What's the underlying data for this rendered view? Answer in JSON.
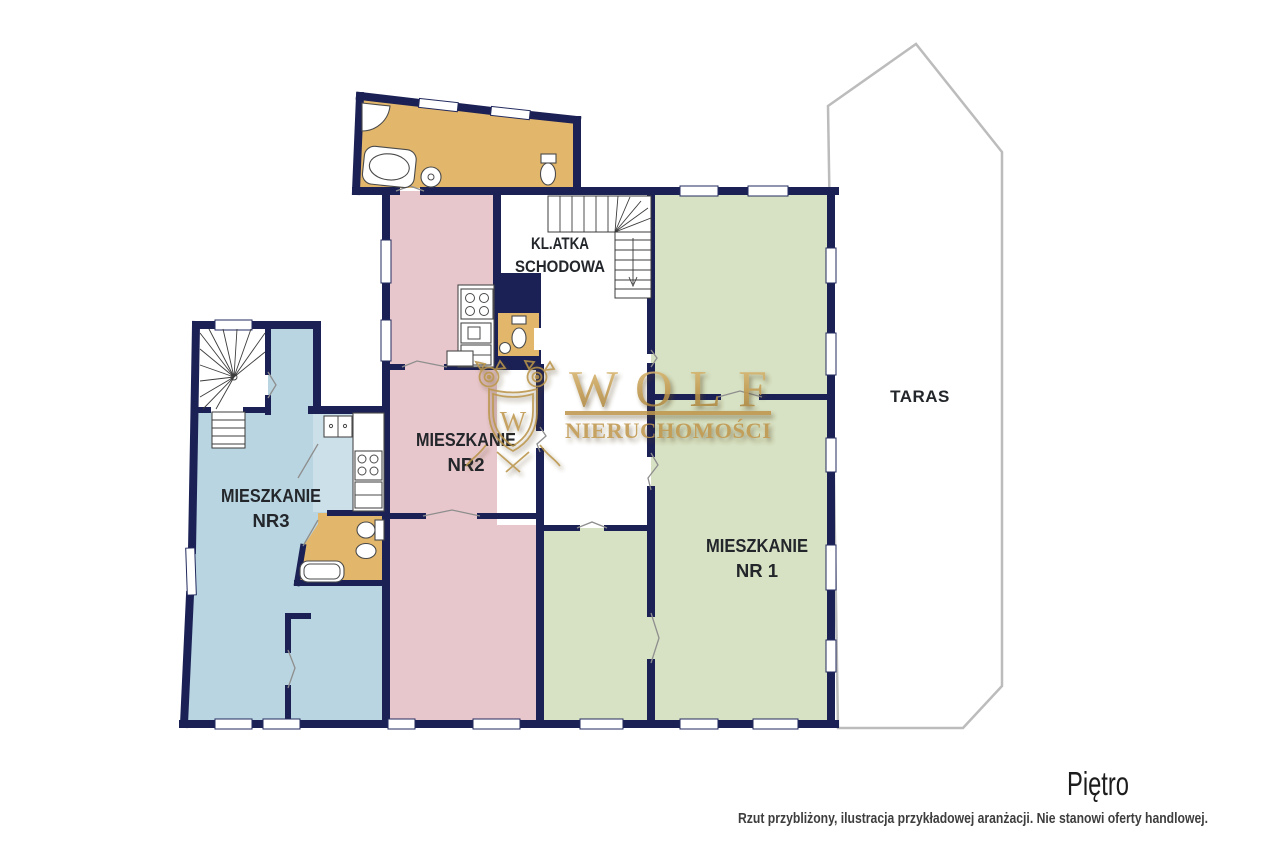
{
  "floor_plan": {
    "wall_color": "#1b2155",
    "terrace_outline_color": "#bcbcbc",
    "label_color": "#23262a",
    "rooms": {
      "apartment_1": {
        "label_line1": "MIESZKANIE",
        "label_line2": "NR 1",
        "fill": "#d7e1c3"
      },
      "apartment_2": {
        "label_line1": "MIESZKANIE",
        "label_line2": "NR2",
        "fill": "#e8c7cc"
      },
      "apartment_3": {
        "label_line1": "MIESZKANIE",
        "label_line2": "NR3",
        "fill": "#b9d5e1"
      },
      "staircase": {
        "label_line1": "KL.ATKA",
        "label_line2": "SCHODOWA",
        "fill": "#ffffff"
      },
      "terrace": {
        "label": "TARAS",
        "fill": "#ffffff"
      },
      "bathroom_fill": "#e3b76b",
      "kitchen_fill": "#cbe0e9"
    }
  },
  "watermark": {
    "brand": "WOLF",
    "subtitle": "NIERUCHOMOŚCI",
    "monogram": "W",
    "gold_color": "#bf974d"
  },
  "footer": {
    "floor_label": "Piętro",
    "disclaimer": "Rzut przybliżony, ilustracja przykładowej aranżacji. Nie stanowi oferty handlowej."
  }
}
